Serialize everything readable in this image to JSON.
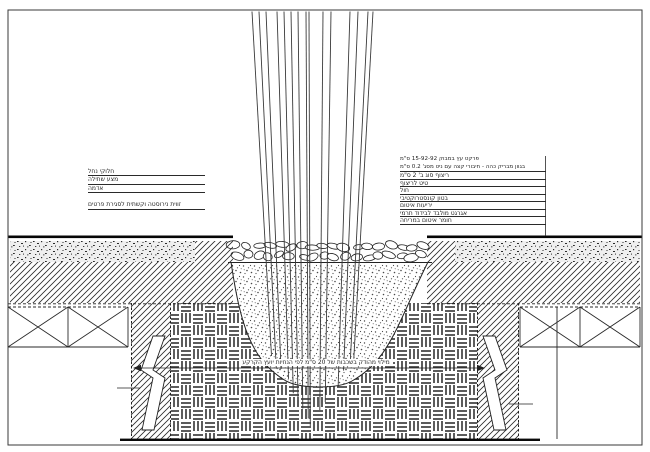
{
  "labels": {
    "left": [
      "חלוקי נחל",
      "מצע שתילה",
      "אדמה",
      "זווית נירוסטה וקשתית לסגירת פרטים"
    ],
    "right_title_line1": "פרקט עץ במבוק 15-92-92 ס\"מ",
    "right_title_line2": "בגוון מבריק כהה - חיבורי קצה עם ניט מסג' 0.2 ס\"מ",
    "right": [
      "ריצוף סוג ב' 2 ס\"מ",
      "טיט לריצוף",
      "חול",
      "בטון קונסטרוקטיבי",
      "יריעות איטום",
      "אגרגט מולבד לבידוד תרמי",
      "חומר איטום במריחה"
    ],
    "center_note": "מילוי מהודק בשכבות של 20 ס\"מ לפי הנחיות יועץ הקרקע"
  },
  "colors": {
    "ink": "#1f1f1f",
    "background": "#ffffff"
  }
}
